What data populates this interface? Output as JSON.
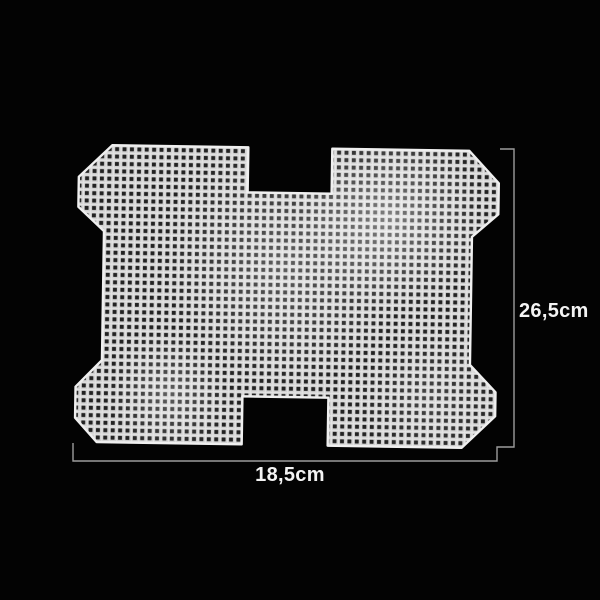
{
  "image": {
    "subject": "white plastic canvas mesh sheet with square grid holes, H-shaped blank with chamfered corner tabs and notched top/bottom center, shown on black background with measurement callouts"
  },
  "dimensions": {
    "height_label": "26,5cm",
    "width_label": "18,5cm"
  },
  "colors": {
    "background": "#030303",
    "mesh_base": "#d2d2d2",
    "mesh_highlight": "#e3e3e3",
    "mesh_edge": "#efefef",
    "mesh_hole": "#232323",
    "dimension_line": "#9c9c9c",
    "label_text": "#f3f3f3"
  }
}
